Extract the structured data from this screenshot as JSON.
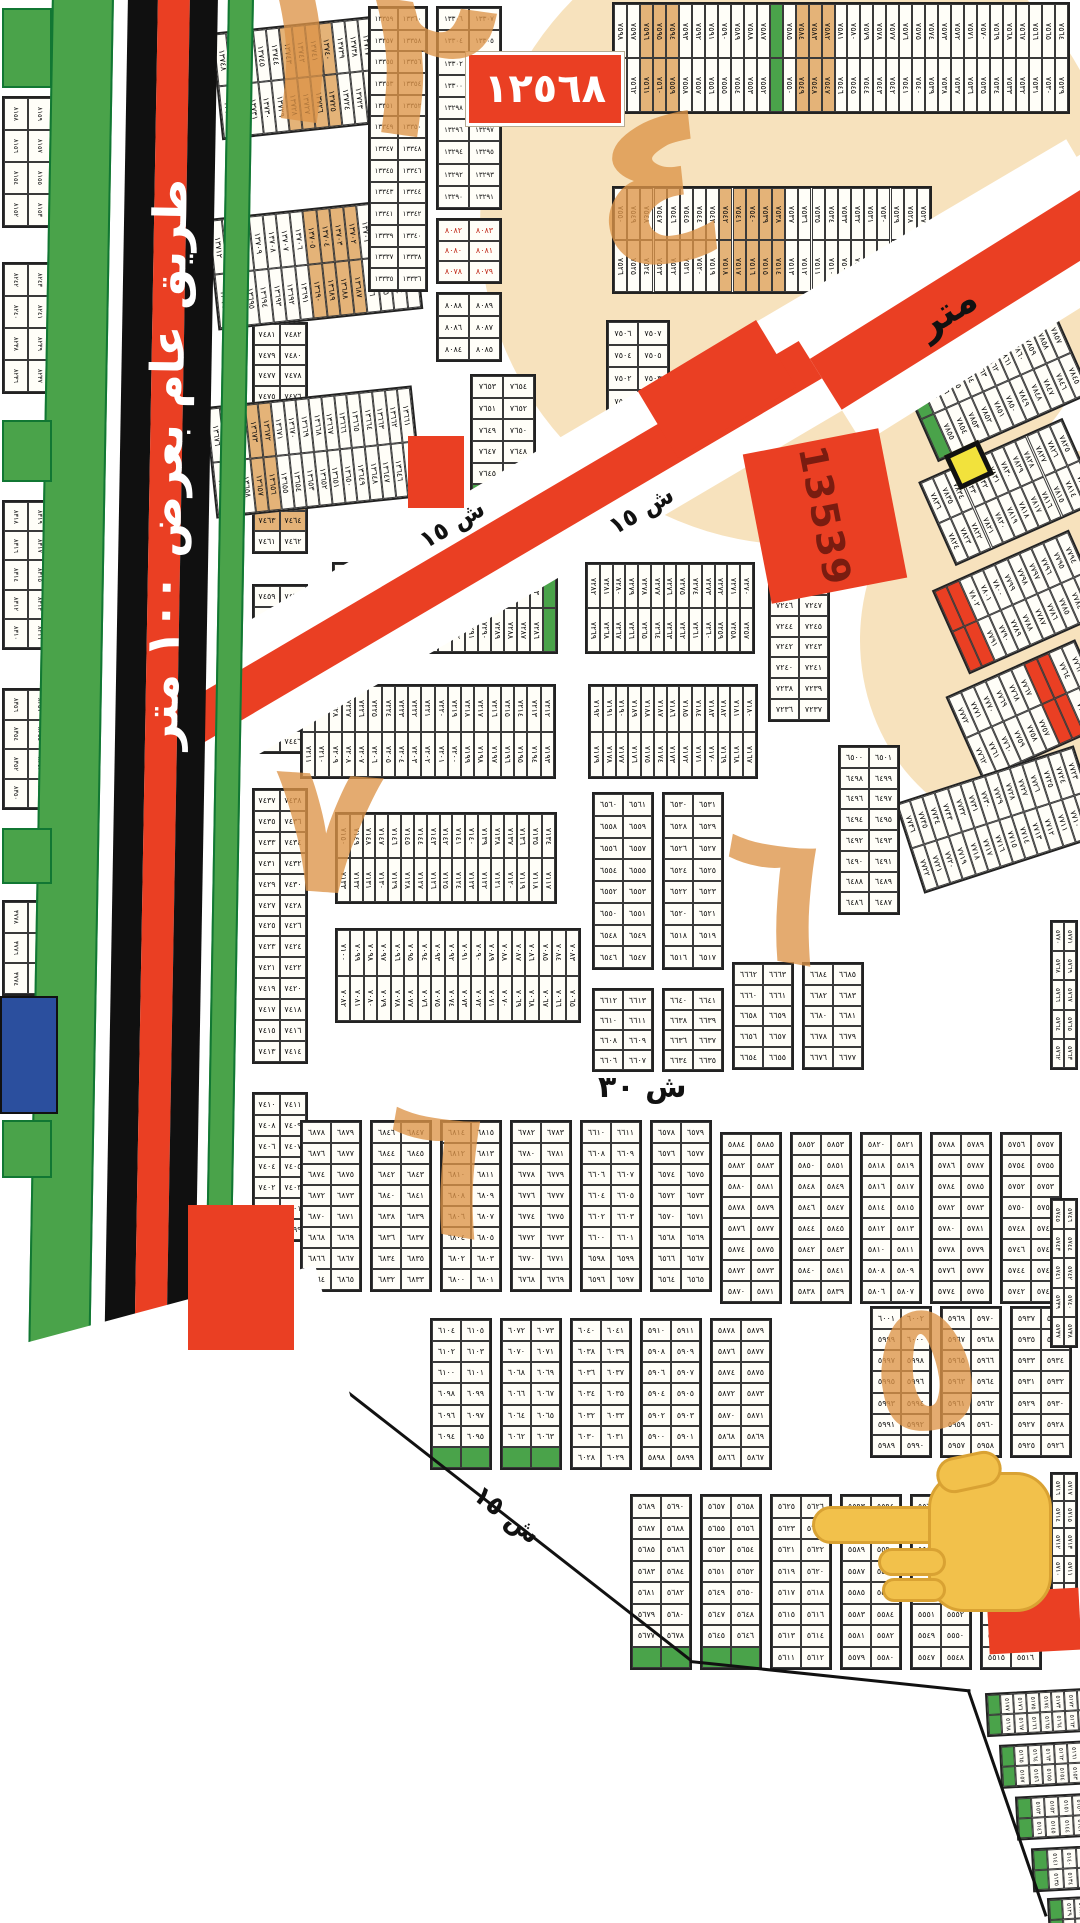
{
  "map": {
    "highway": {
      "label": "طريق عام بعرض ١٠٠ متر"
    },
    "road15": {
      "label": "ش ١٥",
      "label2": "ش ١٥"
    },
    "road_top_right": {
      "label": "متر"
    },
    "street30": {
      "label": "ش ٣٠"
    },
    "street15_bottom": {
      "label": "ش ١٥"
    },
    "block_number_box": "١٢٥٦٨",
    "plot_13539": "13539",
    "colors": {
      "paper": "#ffffff",
      "green": "#4aa34a",
      "red": "#ea3f23",
      "cream": "#f7e2bd",
      "tan": "#e4b378",
      "annotation": "#dd9448",
      "blue": "#2b4f9e",
      "yellow": "#f2e23c",
      "hand": "#f2c14b",
      "cell_border": "#3a3a3a",
      "number": "#101010",
      "number_red": "#c02a1a"
    },
    "annotations": [
      {
        "t": "١٢",
        "x": 236,
        "y": -38,
        "fs": 210,
        "r": 8
      },
      {
        "t": "٤",
        "x": 588,
        "y": 80,
        "fs": 230,
        "r": -6
      },
      {
        "t": "٧",
        "x": 270,
        "y": 745,
        "fs": 185,
        "r": 4
      },
      {
        "t": "٦",
        "x": 716,
        "y": 812,
        "fs": 185,
        "r": 10
      },
      {
        "t": "٦",
        "x": 380,
        "y": 1085,
        "fs": 185,
        "r": 10
      },
      {
        "t": "٥",
        "x": 868,
        "y": 1282,
        "fs": 185,
        "r": -8
      }
    ],
    "blobs": [
      {
        "x": 800,
        "y": 225,
        "rx": 320,
        "ry": 320
      },
      {
        "x": 1035,
        "y": 640,
        "rx": 175,
        "ry": 195
      }
    ],
    "boundary_segments": [
      {
        "x": 293,
        "y": 1348,
        "l": 505,
        "a": 38
      },
      {
        "x": 690,
        "y": 1660,
        "l": 282,
        "a": 6
      },
      {
        "x": 968,
        "y": 1688,
        "l": 240,
        "a": 71
      }
    ],
    "green_rects": [
      {
        "x": 2,
        "y": 8,
        "w": 50,
        "h": 80
      },
      {
        "x": 2,
        "y": 420,
        "w": 50,
        "h": 62
      },
      {
        "x": 2,
        "y": 828,
        "w": 50,
        "h": 56
      },
      {
        "x": 2,
        "y": 1120,
        "w": 50,
        "h": 58
      }
    ],
    "red_rects": [
      {
        "x": 408,
        "y": 436,
        "w": 56,
        "h": 72
      },
      {
        "x": 648,
        "y": 350,
        "w": 138,
        "h": 78,
        "a": -31
      },
      {
        "x": 188,
        "y": 1205,
        "w": 106,
        "h": 145
      },
      {
        "x": 988,
        "y": 1590,
        "w": 92,
        "h": 62,
        "a": -3
      }
    ],
    "blocks": [
      {
        "t": "PV",
        "x": 2,
        "y": 96,
        "w": 52,
        "h": 132,
        "s": 8158
      },
      {
        "t": "PV",
        "x": 2,
        "y": 262,
        "w": 52,
        "h": 132,
        "s": 8242
      },
      {
        "t": "PV",
        "x": 2,
        "y": 500,
        "w": 52,
        "h": 150,
        "s": 8318
      },
      {
        "t": "PV",
        "x": 2,
        "y": 688,
        "w": 52,
        "h": 122,
        "s": 8356
      },
      {
        "t": "PV",
        "x": 2,
        "y": 900,
        "w": 52,
        "h": 96,
        "s": 3778
      },
      {
        "t": "P",
        "x": 252,
        "y": 322,
        "w": 56,
        "h": 232,
        "r": 11,
        "s": 7481,
        "hl": [
          8,
          9
        ]
      },
      {
        "t": "P",
        "x": 252,
        "y": 584,
        "w": 56,
        "h": 170,
        "r": 8,
        "s": 7459
      },
      {
        "t": "P",
        "x": 252,
        "y": 788,
        "w": 56,
        "h": 276,
        "r": 13,
        "s": 7437
      },
      {
        "t": "P",
        "x": 252,
        "y": 1092,
        "w": 56,
        "h": 150,
        "r": 7,
        "s": 7410
      },
      {
        "t": "S",
        "x": 216,
        "y": 22,
        "w": 202,
        "h": 108,
        "s": 13748,
        "rot": -6,
        "hl": [
          5,
          6,
          7,
          8
        ]
      },
      {
        "t": "S",
        "x": 212,
        "y": 208,
        "w": 206,
        "h": 112,
        "s": 13712,
        "rot": -6,
        "hl": [
          7,
          8,
          9,
          10
        ]
      },
      {
        "t": "S",
        "x": 210,
        "y": 396,
        "w": 208,
        "h": 112,
        "s": 13676,
        "rot": -6,
        "hl": [
          3,
          4
        ]
      },
      {
        "t": "P",
        "x": 368,
        "y": 6,
        "w": 60,
        "h": 286,
        "r": 13,
        "s": 13359
      },
      {
        "t": "P",
        "x": 436,
        "y": 6,
        "w": 66,
        "h": 204,
        "r": 9,
        "s": 13306
      },
      {
        "t": "P",
        "x": 436,
        "y": 218,
        "w": 66,
        "h": 66,
        "r": 3,
        "s": 8082,
        "red": 1
      },
      {
        "t": "P",
        "x": 436,
        "y": 292,
        "w": 66,
        "h": 70,
        "r": 3,
        "s": 8088
      },
      {
        "t": "P",
        "x": 470,
        "y": 374,
        "w": 66,
        "h": 134,
        "r": 6,
        "s": 7653,
        "g": "last"
      },
      {
        "t": "S",
        "x": 612,
        "y": 2,
        "w": 458,
        "h": 112,
        "s": 7598,
        "gi": [
          12
        ],
        "hl": [
          2,
          3,
          4,
          14,
          15,
          16
        ]
      },
      {
        "t": "S",
        "x": 612,
        "y": 186,
        "w": 320,
        "h": 108,
        "s": 7550,
        "hl": [
          8,
          9,
          10,
          11,
          12
        ]
      },
      {
        "t": "P",
        "x": 606,
        "y": 320,
        "w": 64,
        "h": 140,
        "r": 6,
        "s": 7506
      },
      {
        "t": "S",
        "x": 912,
        "y": 340,
        "w": 168,
        "h": 92,
        "s": 7868,
        "rot": -24,
        "gi": [
          0
        ]
      },
      {
        "t": "S",
        "x": 930,
        "y": 446,
        "w": 158,
        "h": 92,
        "s": 7836,
        "rot": -24
      },
      {
        "t": "S",
        "x": 944,
        "y": 556,
        "w": 150,
        "h": 92,
        "s": 7804,
        "rot": -24,
        "ri": [
          0,
          1
        ]
      },
      {
        "t": "S",
        "x": 958,
        "y": 664,
        "w": 142,
        "h": 92,
        "s": 7772,
        "rot": -24,
        "ri": [
          6,
          7
        ]
      },
      {
        "t": "S",
        "x": 905,
        "y": 772,
        "w": 188,
        "h": 95,
        "s": 7736,
        "rot": -18
      },
      {
        "t": "S",
        "x": 332,
        "y": 562,
        "w": 226,
        "h": 92,
        "s": 7318,
        "gi": [
          16
        ]
      },
      {
        "t": "S",
        "x": 585,
        "y": 562,
        "w": 170,
        "h": 92,
        "s": 7282
      },
      {
        "t": "P",
        "x": 768,
        "y": 572,
        "w": 62,
        "h": 150,
        "r": 7,
        "s": 7248
      },
      {
        "t": "S",
        "x": 300,
        "y": 684,
        "w": 256,
        "h": 95,
        "s": 7230
      },
      {
        "t": "S",
        "x": 588,
        "y": 684,
        "w": 170,
        "h": 95,
        "s": 7192
      },
      {
        "t": "P",
        "x": 838,
        "y": 745,
        "w": 62,
        "h": 170,
        "r": 8,
        "s": 6500
      },
      {
        "t": "S",
        "x": 335,
        "y": 812,
        "w": 222,
        "h": 92,
        "s": 7150
      },
      {
        "t": "S",
        "x": 335,
        "y": 928,
        "w": 246,
        "h": 95,
        "s": 7100
      },
      {
        "t": "P",
        "x": 592,
        "y": 792,
        "w": 62,
        "h": 178,
        "r": 8,
        "s": 6560
      },
      {
        "t": "P",
        "x": 662,
        "y": 792,
        "w": 62,
        "h": 178,
        "r": 8,
        "s": 6530
      },
      {
        "t": "P",
        "x": 592,
        "y": 988,
        "w": 62,
        "h": 84,
        "r": 4,
        "s": 6612
      },
      {
        "t": "P",
        "x": 662,
        "y": 988,
        "w": 62,
        "h": 84,
        "r": 4,
        "s": 6640
      },
      {
        "t": "P",
        "x": 732,
        "y": 962,
        "w": 62,
        "h": 108,
        "r": 5,
        "s": 6662
      },
      {
        "t": "P",
        "x": 802,
        "y": 962,
        "w": 62,
        "h": 108,
        "r": 5,
        "s": 6684
      },
      {
        "t": "P",
        "x": 300,
        "y": 1120,
        "w": 62,
        "h": 172,
        "r": 8,
        "s": 6878
      },
      {
        "t": "P",
        "x": 370,
        "y": 1120,
        "w": 62,
        "h": 172,
        "r": 8,
        "s": 6846
      },
      {
        "t": "P",
        "x": 440,
        "y": 1120,
        "w": 62,
        "h": 172,
        "r": 8,
        "s": 6814
      },
      {
        "t": "P",
        "x": 510,
        "y": 1120,
        "w": 62,
        "h": 172,
        "r": 8,
        "s": 6782
      },
      {
        "t": "P",
        "x": 580,
        "y": 1120,
        "w": 62,
        "h": 172,
        "r": 8,
        "s": 6610
      },
      {
        "t": "P",
        "x": 650,
        "y": 1120,
        "w": 62,
        "h": 172,
        "r": 8,
        "s": 6578
      },
      {
        "t": "P",
        "x": 720,
        "y": 1132,
        "w": 62,
        "h": 172,
        "r": 8,
        "s": 5884
      },
      {
        "t": "P",
        "x": 790,
        "y": 1132,
        "w": 62,
        "h": 172,
        "r": 8,
        "s": 5852
      },
      {
        "t": "P",
        "x": 860,
        "y": 1132,
        "w": 62,
        "h": 172,
        "r": 8,
        "s": 5820
      },
      {
        "t": "P",
        "x": 930,
        "y": 1132,
        "w": 62,
        "h": 172,
        "r": 8,
        "s": 5788
      },
      {
        "t": "P",
        "x": 1000,
        "y": 1132,
        "w": 62,
        "h": 172,
        "r": 8,
        "s": 5756
      },
      {
        "t": "P",
        "x": 430,
        "y": 1318,
        "w": 62,
        "h": 152,
        "r": 7,
        "s": 6104,
        "g": "last"
      },
      {
        "t": "P",
        "x": 500,
        "y": 1318,
        "w": 62,
        "h": 152,
        "r": 7,
        "s": 6072,
        "g": "last"
      },
      {
        "t": "P",
        "x": 570,
        "y": 1318,
        "w": 62,
        "h": 152,
        "r": 7,
        "s": 6040
      },
      {
        "t": "P",
        "x": 640,
        "y": 1318,
        "w": 62,
        "h": 152,
        "r": 7,
        "s": 5910
      },
      {
        "t": "P",
        "x": 710,
        "y": 1318,
        "w": 62,
        "h": 152,
        "r": 7,
        "s": 5878
      },
      {
        "t": "P",
        "x": 870,
        "y": 1306,
        "w": 62,
        "h": 152,
        "r": 7,
        "s": 6001
      },
      {
        "t": "P",
        "x": 940,
        "y": 1306,
        "w": 62,
        "h": 152,
        "r": 7,
        "s": 5969
      },
      {
        "t": "P",
        "x": 1010,
        "y": 1306,
        "w": 62,
        "h": 152,
        "r": 7,
        "s": 5937
      },
      {
        "t": "P",
        "x": 630,
        "y": 1494,
        "w": 62,
        "h": 176,
        "r": 8,
        "s": 5689,
        "g": "last"
      },
      {
        "t": "P",
        "x": 700,
        "y": 1494,
        "w": 62,
        "h": 176,
        "r": 8,
        "s": 5657,
        "g": "last"
      },
      {
        "t": "P",
        "x": 770,
        "y": 1494,
        "w": 62,
        "h": 176,
        "r": 8,
        "s": 5625
      },
      {
        "t": "P",
        "x": 840,
        "y": 1494,
        "w": 62,
        "h": 176,
        "r": 8,
        "s": 5593
      },
      {
        "t": "P",
        "x": 910,
        "y": 1494,
        "w": 62,
        "h": 176,
        "r": 8,
        "s": 5561
      },
      {
        "t": "P",
        "x": 980,
        "y": 1494,
        "w": 62,
        "h": 176,
        "r": 8,
        "s": 5529
      },
      {
        "t": "PV",
        "x": 1050,
        "y": 920,
        "w": 28,
        "h": 150,
        "s": 5770
      },
      {
        "t": "PV",
        "x": 1050,
        "y": 1198,
        "w": 28,
        "h": 150,
        "s": 5745
      },
      {
        "t": "PV",
        "x": 1050,
        "y": 1472,
        "w": 28,
        "h": 140,
        "s": 5716
      },
      {
        "t": "S",
        "x": 986,
        "y": 1690,
        "w": 120,
        "h": 44,
        "s": 5178,
        "gi": [
          0
        ],
        "rot": -3
      },
      {
        "t": "S",
        "x": 1000,
        "y": 1742,
        "w": 110,
        "h": 44,
        "s": 5166,
        "gi": [
          0
        ],
        "rot": -3
      },
      {
        "t": "S",
        "x": 1016,
        "y": 1794,
        "w": 100,
        "h": 44,
        "s": 5154,
        "gi": [
          0
        ],
        "rot": -3
      },
      {
        "t": "S",
        "x": 1032,
        "y": 1846,
        "w": 90,
        "h": 44,
        "s": 5142,
        "gi": [
          0
        ],
        "rot": -3
      },
      {
        "t": "S",
        "x": 1048,
        "y": 1896,
        "w": 80,
        "h": 44,
        "s": 5130,
        "gi": [
          0
        ],
        "rot": -3
      }
    ]
  }
}
